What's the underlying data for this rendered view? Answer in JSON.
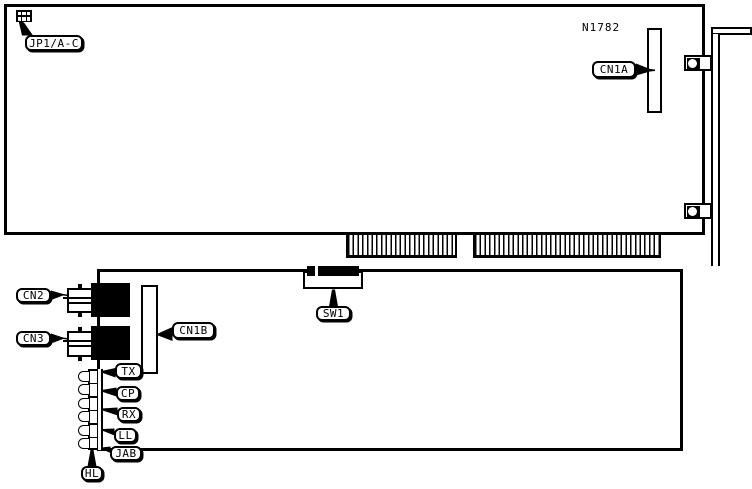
{
  "labels": {
    "jp1": "JP1/A-C",
    "board_ref": "N1782",
    "cn1a": "CN1A",
    "cn2": "CN2",
    "cn3": "CN3",
    "cn1b": "CN1B",
    "sw1": "SW1",
    "led_tx": "TX",
    "led_cp": "CP",
    "led_rx": "RX",
    "led_ll": "LL",
    "led_jab": "JAB",
    "led_hl": "HL"
  },
  "colors": {
    "ink": "#000000",
    "background": "#ffffff"
  }
}
